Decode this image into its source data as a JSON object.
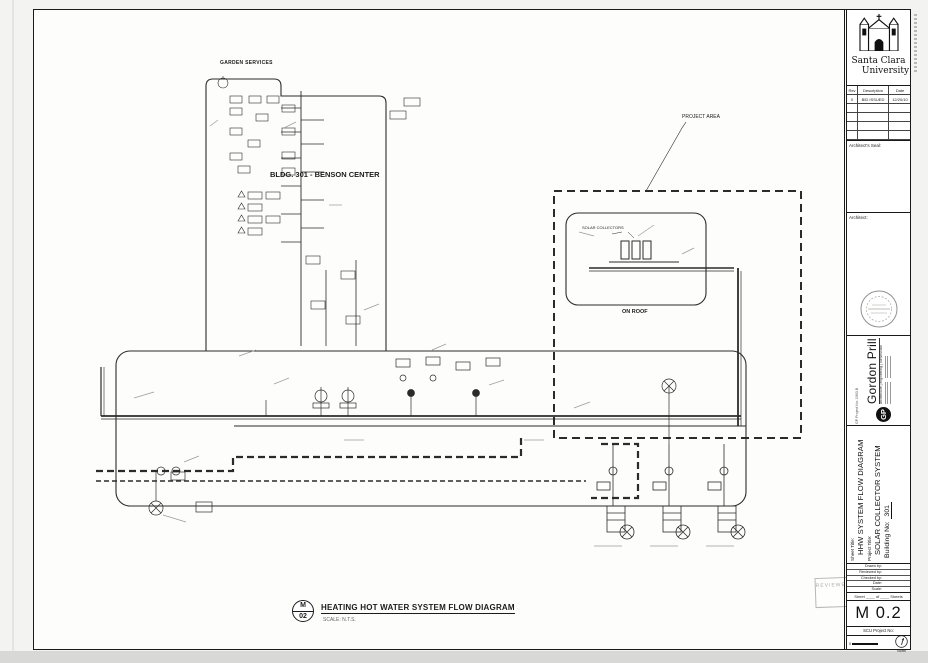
{
  "drawing": {
    "services_label": "GARDEN SERVICES",
    "building_label": "BLDG. 301 - BENSON CENTER",
    "project_area_label": "PROJECT AREA",
    "on_roof_label": "ON ROOF",
    "solar_collectors_label": "SOLAR COLLECTORS",
    "title_bubble_letter": "M",
    "title_bubble_number": "02",
    "main_title": "HEATING HOT WATER SYSTEM FLOW DIAGRAM",
    "scale_note": "SCALE:   N.T.S.",
    "reviewed_stamp": "REVIEWED"
  },
  "titleblock": {
    "university_line1": "Santa Clara",
    "university_line2": "University",
    "revisions": {
      "headers": [
        "Rev",
        "Description",
        "Date"
      ],
      "rows": [
        [
          "0",
          "BID ISSUED",
          "12/20/10"
        ]
      ]
    },
    "architect_seal_label": "Architect's Seal:",
    "architect_label": "Architect:",
    "firm": {
      "logo": "GP",
      "name": "Gordon Prill",
      "tagline": "architecture | engineering | construction",
      "project_no": "GP Project No: 1903 B"
    },
    "sheet_meta": {
      "sheet_title_label": "Sheet Title:",
      "sheet_title": "HHW SYSTEM FLOW DIAGRAM",
      "project_title_label": "Project Title:",
      "building_no_label": "Building No:",
      "project_title": "SOLAR COLLECTOR SYSTEM",
      "building_no": "301"
    },
    "field_labels": [
      "Drawn by:",
      "Reviewed by:",
      "Checked by:",
      "Date:",
      "Scale:"
    ],
    "sheet_line": "Sheet ____ of ____ Sheets",
    "sheet_number": "M 0.2",
    "scu_project_label": "SCU Project No:",
    "scale_zero": "0",
    "north_label": "North"
  },
  "colors": {
    "line": "#2b2b2b",
    "stamp": "#aeaeab",
    "paper": "#fdfdfc"
  }
}
